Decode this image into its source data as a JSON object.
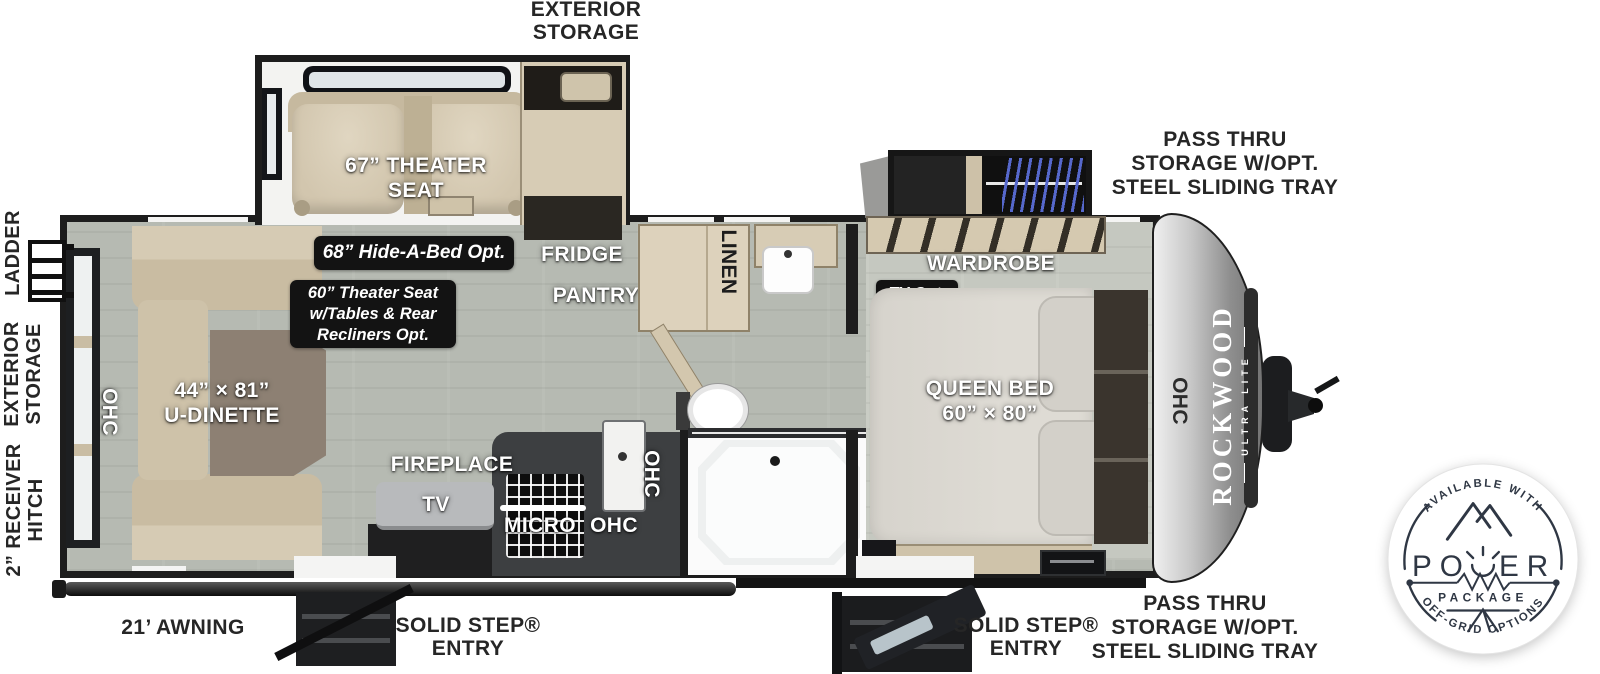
{
  "exterior": {
    "exterior_storage_top": "EXTERIOR\nSTORAGE",
    "ladder": "LADDER",
    "exterior_storage_left": "EXTERIOR\nSTORAGE",
    "receiver_hitch": "2” RECEIVER\nHITCH",
    "awning": "21’ AWNING",
    "entry_door_1": "SOLID STEP®\nENTRY",
    "entry_door_2": "SOLID STEP®\nENTRY",
    "pass_thru_top": "PASS THRU\nSTORAGE W/OPT.\nSTEEL SLIDING TRAY",
    "pass_thru_bottom": "PASS THRU\nSTORAGE W/OPT.\nSTEEL SLIDING TRAY"
  },
  "interior": {
    "theater_seat": "67” THEATER\nSEAT",
    "fridge": "FRIDGE",
    "pantry": "PANTRY",
    "linen": "LINEN",
    "u_dinette": "44” × 81”\nU-DINETTE",
    "fireplace": "FIREPLACE",
    "tv": "TV",
    "micro": "MICRO",
    "ohc_rear": "OHC",
    "ohc_kitchen_vertical": "OHC",
    "ohc_kitchen": "OHC",
    "ohc_front": "OHC",
    "wardrobe": "WARDROBE",
    "queen_bed": "QUEEN BED\n60” × 80”"
  },
  "options": {
    "hide_a_bed": "68” Hide-A-Bed Opt.",
    "theater_seat_upgrade": "60” Theater Seat\nw/Tables & Rear\nRecliners Opt.",
    "tv_option": "TV Opt."
  },
  "brand": {
    "name": "ROCKWOOD",
    "sub": "ULTRA LITE"
  },
  "power_badge": {
    "arc_top": "AVAILABLE WITH",
    "word": "POWER",
    "word_left": "PO",
    "word_right": "ER",
    "package": "PACKAGE",
    "arc_bottom": "OFF-GRID OPTIONS"
  },
  "colors": {
    "floor": "#b6bab2",
    "wall": "#1d1d1d",
    "cabinet_tan": "#d7ccb5",
    "badge_bg": "#131313",
    "spring_blue": "#5668cc",
    "badge_ink": "#2f3744",
    "label_white": "#ffffff",
    "label_black": "#262626"
  }
}
